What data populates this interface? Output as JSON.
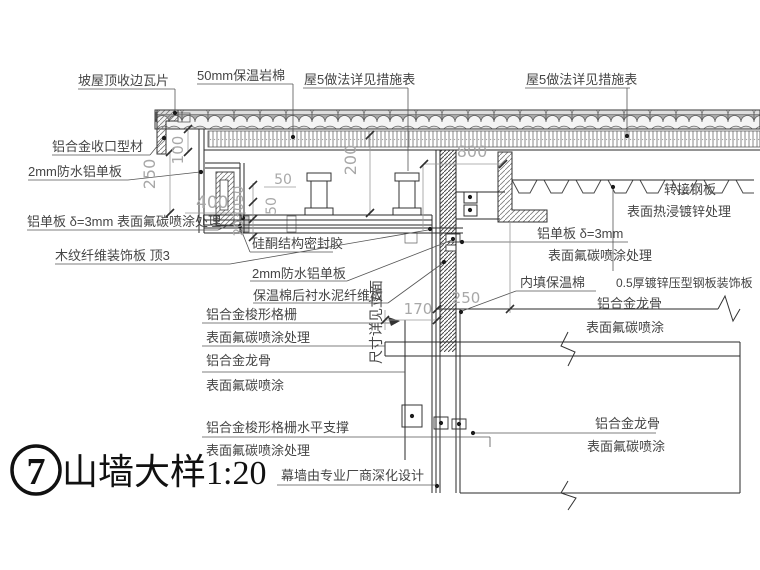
{
  "colors": {
    "main_line": "#2a2a2a",
    "secondary_line": "#555555",
    "label_text": "#454545",
    "dimension_text": "#a8a8a8",
    "title_text": "#111111",
    "hatch": "#777777"
  },
  "title": {
    "number": "7",
    "name": "山墙大样",
    "scale": "1:20"
  },
  "labels": {
    "roof_tile_edge": "坡屋顶收边瓦片",
    "rock_wool_50": "50mm保温岩棉",
    "roof5_note_left": "屋5做法详见措施表",
    "roof5_note_right": "屋5做法详见措施表",
    "alum_closing_profile": "铝合金收口型材",
    "waterproof_alum_left": "2mm防水铝单板",
    "alum_panel_left": "铝单板 δ=3mm  表面氟碳喷涂处理",
    "wood_fiber_board": "木纹纤维装饰板 顶3",
    "silicone_sealant": "硅酮结构密封胶",
    "waterproof_alum_center": "2mm防水铝单板",
    "cement_fiber_backing": "保温棉后衬水泥纤维板",
    "see_elevation": "尺寸详见立面",
    "infill_insulation": "内填保温棉",
    "transfer_steel_plate": "转接钢板",
    "hot_dip_galvanized": "表面热浸镀锌处理",
    "alum_panel_right": "铝单板 δ=3mm",
    "fluorocarbon_right": "表面氟碳喷涂处理",
    "steel_deco_panel": "0.5厚镀锌压型钢板装饰板",
    "alum_keel_right_upper": "铝合金龙骨",
    "fluoro_spray_right_upper": "表面氟碳喷涂",
    "alum_keel_right_lower": "铝合金龙骨",
    "fluoro_spray_right_lower": "表面氟碳喷涂",
    "spindle_grille": "铝合金梭形格栅",
    "spindle_grille_finish": "表面氟碳喷涂处理",
    "alum_keel_left": "铝合金龙骨",
    "alum_keel_left_finish": "表面氟碳喷涂",
    "grille_horizontal_support": "铝合金梭形格栅水平支撑",
    "support_finish": "表面氟碳喷涂处理",
    "curtain_wall_note": "幕墙由专业厂商深化设计"
  },
  "dimensions": {
    "d100": "100",
    "d250_eave": "250",
    "d200": "200",
    "d800": "800",
    "d400": "400",
    "d50_a": "50",
    "d50_b": "50",
    "d50_c": "50",
    "d30": "30",
    "d20": "20",
    "d170": "170",
    "d250_grid": "250"
  }
}
